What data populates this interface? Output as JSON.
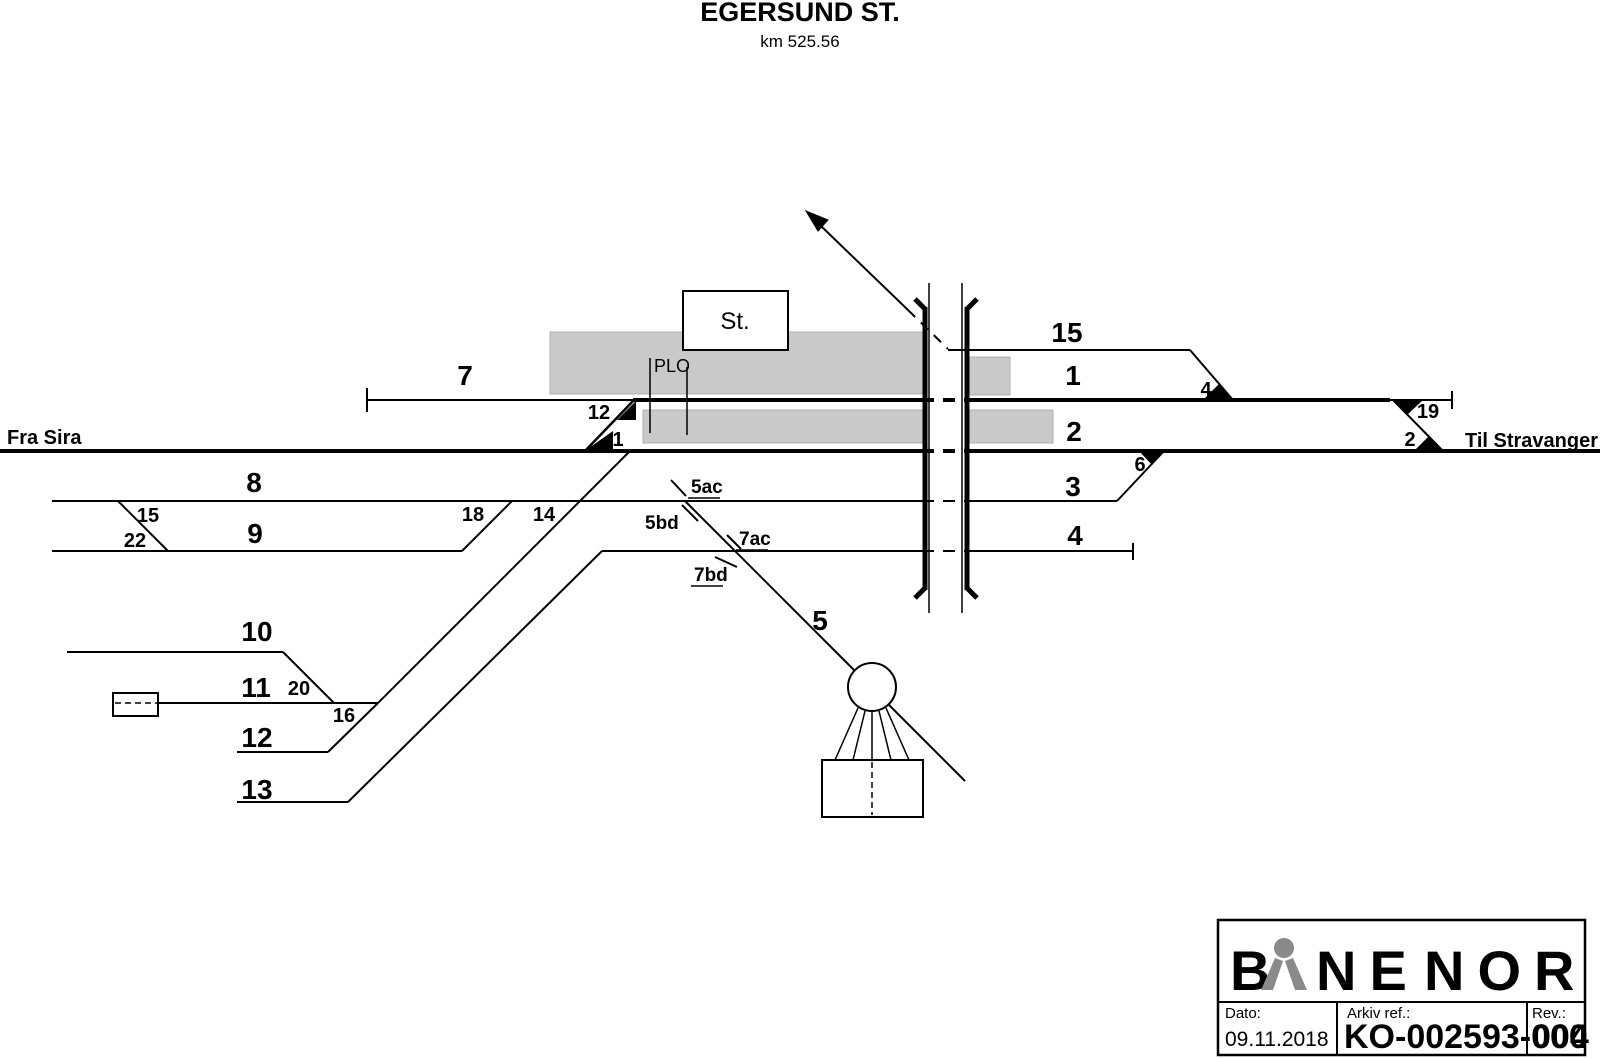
{
  "title": {
    "station": "EGERSUND ST.",
    "km": "km 525.56"
  },
  "endpoints": {
    "left": "Fra Sira",
    "right": "Til Stravanger"
  },
  "station_label": "St.",
  "plo_label": "PLO",
  "track_labels": {
    "t7": "7",
    "t8": "8",
    "t9": "9",
    "t10": "10",
    "t11": "11",
    "t12": "12",
    "t13": "13",
    "t15": "15",
    "t1": "1",
    "t2": "2",
    "t3": "3",
    "t4": "4",
    "t5": "5"
  },
  "switch_labels": {
    "s12": "12",
    "s1": "1",
    "s4": "4",
    "s19": "19",
    "s2": "2",
    "s6": "6",
    "s15": "15",
    "s22": "22",
    "s18": "18",
    "s14": "14",
    "s20": "20",
    "s16": "16"
  },
  "marker_labels": {
    "m5ac": "5ac",
    "m5bd": "5bd",
    "m7ac": "7ac",
    "m7bd": "7bd"
  },
  "title_block": {
    "logo_b": "B",
    "logo_ne": "NE",
    "logo_nor": "NOR",
    "dato_label": "Dato:",
    "dato_value": "09.11.2018",
    "arkiv_label": "Arkiv ref.:",
    "arkiv_value": "KO-002593-000",
    "rev_label": "Rev.:",
    "rev_value": "004"
  },
  "colors": {
    "line": "#000000",
    "platform": "#c9c9c9",
    "logo_gray": "#8a8a8a"
  }
}
